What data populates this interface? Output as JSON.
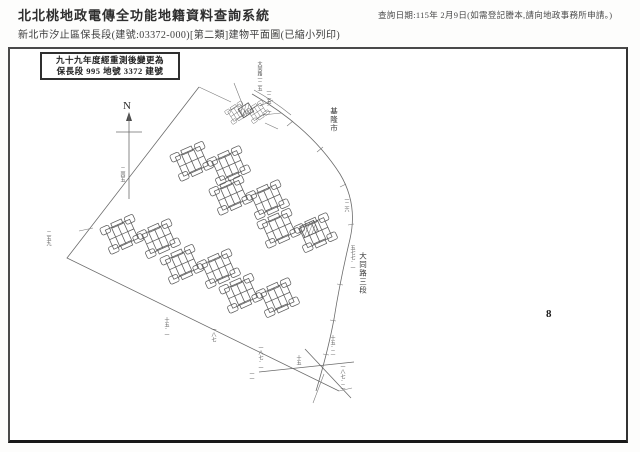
{
  "header": {
    "system_title": "北北桃地政電傳全功能地籍資料查詢系統",
    "query_date": "查詢日期:115年 2月9日(如需登記謄本,請向地政事務所申請。)",
    "doc_title": "新北市汐止區保長段(建號:03372-000)[第二類]建物平面圖(已縮小列印)"
  },
  "page": {
    "remark_box": {
      "line1": "九十九年度經重測後變更為",
      "line2": "保長段 995 地號 3372 建號"
    },
    "map": {
      "north_label": "N",
      "city_label": "基隆市",
      "road_label": "大同路三段",
      "sheet_number": "8",
      "small_labels": [
        {
          "text": "大同路一二五",
          "x": 249,
          "y": 12
        },
        {
          "text": "一二五-一",
          "x": 258,
          "y": 40
        },
        {
          "text": "一二六",
          "x": 336,
          "y": 148
        },
        {
          "text": "五七七-一",
          "x": 342,
          "y": 196
        },
        {
          "text": "二四五",
          "x": 112,
          "y": 118
        },
        {
          "text": "二五九",
          "x": 38,
          "y": 182
        },
        {
          "text": "十五-一",
          "x": 156,
          "y": 268
        },
        {
          "text": "一八七",
          "x": 203,
          "y": 278
        },
        {
          "text": "一八七-一",
          "x": 250,
          "y": 296
        },
        {
          "text": "一一",
          "x": 241,
          "y": 322
        },
        {
          "text": "十五",
          "x": 288,
          "y": 306
        },
        {
          "text": "十五-二",
          "x": 322,
          "y": 286
        },
        {
          "text": "一八七-二",
          "x": 332,
          "y": 315
        }
      ]
    },
    "colors": {
      "frame_border": "#4a4a4a",
      "map_line": "#6b6b6b",
      "text": "#2e2e2e"
    }
  }
}
